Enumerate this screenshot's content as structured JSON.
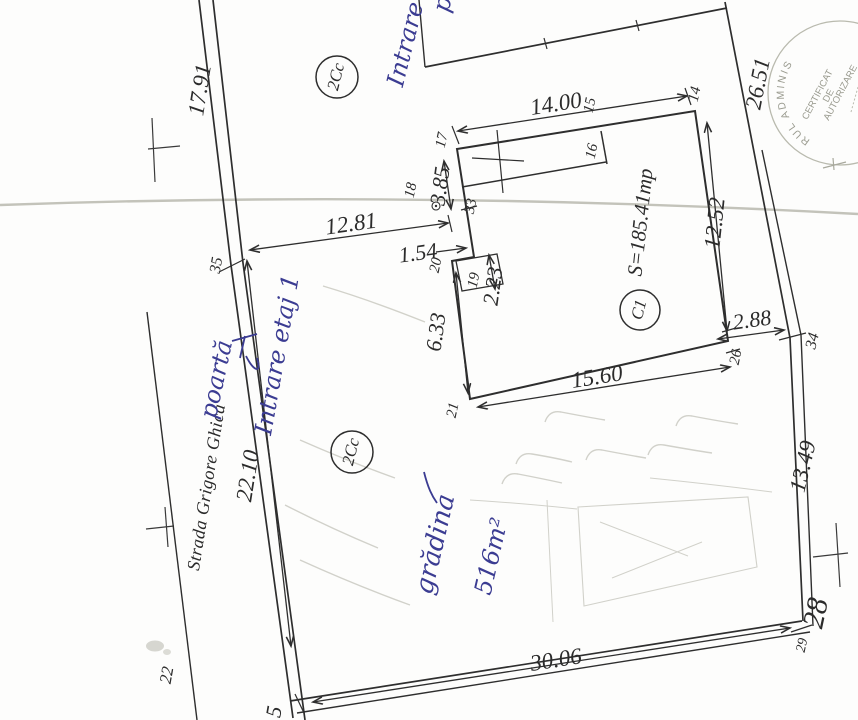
{
  "plan": {
    "street": {
      "name": "Strada Grigore Ghica",
      "point_label": "22"
    },
    "parcel": {
      "zone_labels": {
        "top": "2Cc",
        "bottom": "2Cc"
      },
      "boundary_dims": {
        "left_upper": "17.91",
        "left_lower": "22.10",
        "right_upper": "26.51",
        "right_lower": "13.49",
        "bottom": "30.06",
        "building_to_boundary": "2.88"
      },
      "corner_points": {
        "p5": "5",
        "p14": "14",
        "p15": "15",
        "p28": "28",
        "p29": "29",
        "p34": "34",
        "p35": "35"
      }
    },
    "building": {
      "id": "C1",
      "area": "S=185.41mp",
      "dims": {
        "top": "14.00",
        "right": "12.52",
        "bottom": "15.60",
        "left": "6.33",
        "left_upper": "3.85",
        "step_width": "1.54",
        "porch_depth": "2.23",
        "to_street": "12.81"
      },
      "points": {
        "p16": "16",
        "p17": "17",
        "p18": "18",
        "p19": "19",
        "p20": "20",
        "p21": "21",
        "p26": "26",
        "p33": "33"
      }
    },
    "handwritten": {
      "top_entrance": "Intrare",
      "top_entrance_2": "p",
      "floor_entrance": "Intrare etaj 1",
      "gate": "poartă",
      "garden": "grădina",
      "garden_area": "516m²"
    },
    "stamp": {
      "arc": "RUL ADMINIS",
      "line1": "CERTIFICAT",
      "line2": "DE",
      "line3": "AUTORIZARE"
    }
  }
}
